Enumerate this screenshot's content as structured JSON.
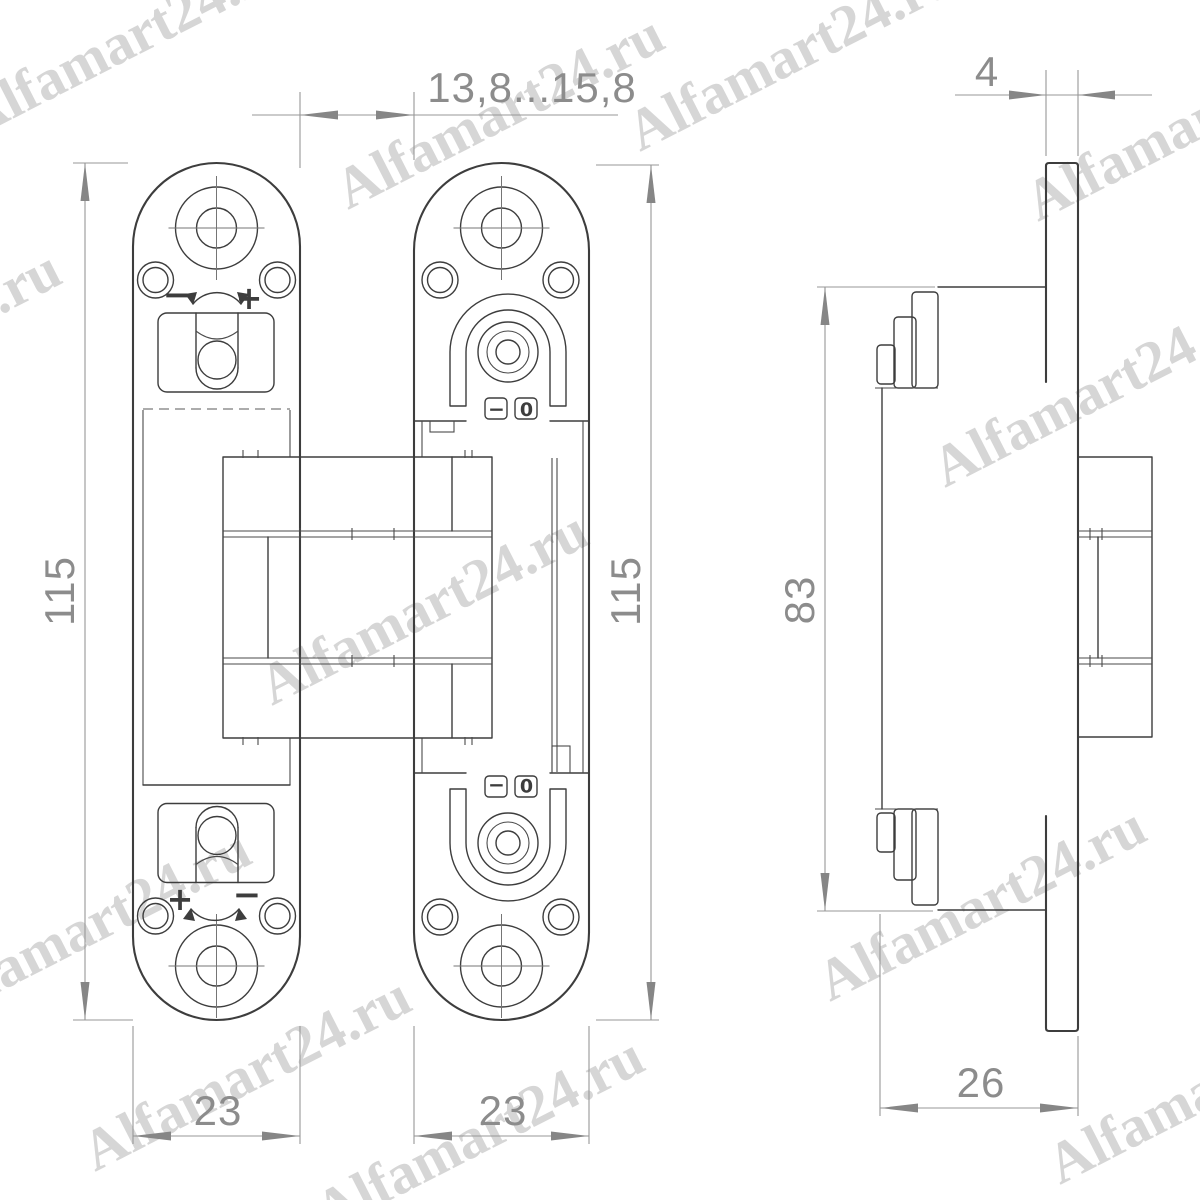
{
  "title": "Concealed door hinge technical drawing",
  "watermark": {
    "text": "Alfamart24.ru",
    "color": "#d2d2d2"
  },
  "dimensions": {
    "gap_range": "13,8...15,8",
    "plate_thickness": "4",
    "left_view_height": "115",
    "middle_view_height": "115",
    "side_body_height": "83",
    "left_view_width": "23",
    "middle_view_width": "23",
    "side_view_depth": "26"
  },
  "adjustment_symbols": {
    "plus": "+",
    "minus": "−",
    "zero": "0"
  },
  "colors": {
    "line": "#3d3d3d",
    "dimension": "#8c8c8c",
    "watermark": "#d2d2d2"
  }
}
